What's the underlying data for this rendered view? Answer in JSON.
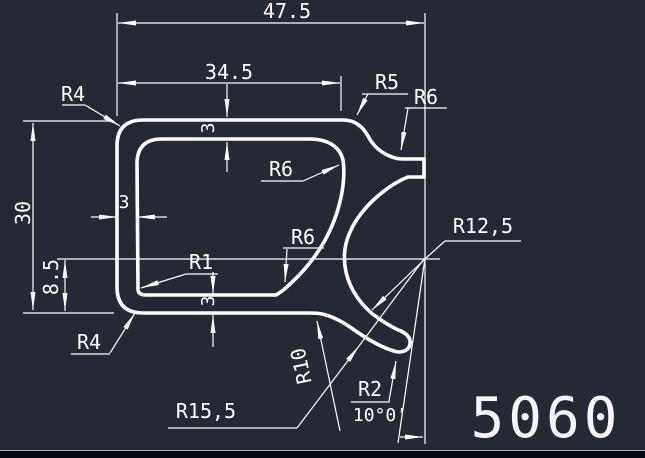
{
  "drawing": {
    "background_color": "#242933",
    "line_color": "#ffffff",
    "part_number": "5060",
    "dimensions": {
      "width_overall": "47.5",
      "width_inner": "34.5",
      "height_overall": "30",
      "height_lower": "8.5",
      "wall_top": "3",
      "wall_left": "3",
      "wall_bottom": "3",
      "angle": "10°0'"
    },
    "radii": {
      "r4_top": "R4",
      "r5": "R5",
      "r6_top_right": "R6",
      "r6_inner_top": "R6",
      "r6_inner_bottom": "R6",
      "r12_5": "R12,5",
      "r1": "R1",
      "r4_bottom": "R4",
      "r10": "R10",
      "r2": "R2",
      "r15_5": "R15,5"
    }
  }
}
